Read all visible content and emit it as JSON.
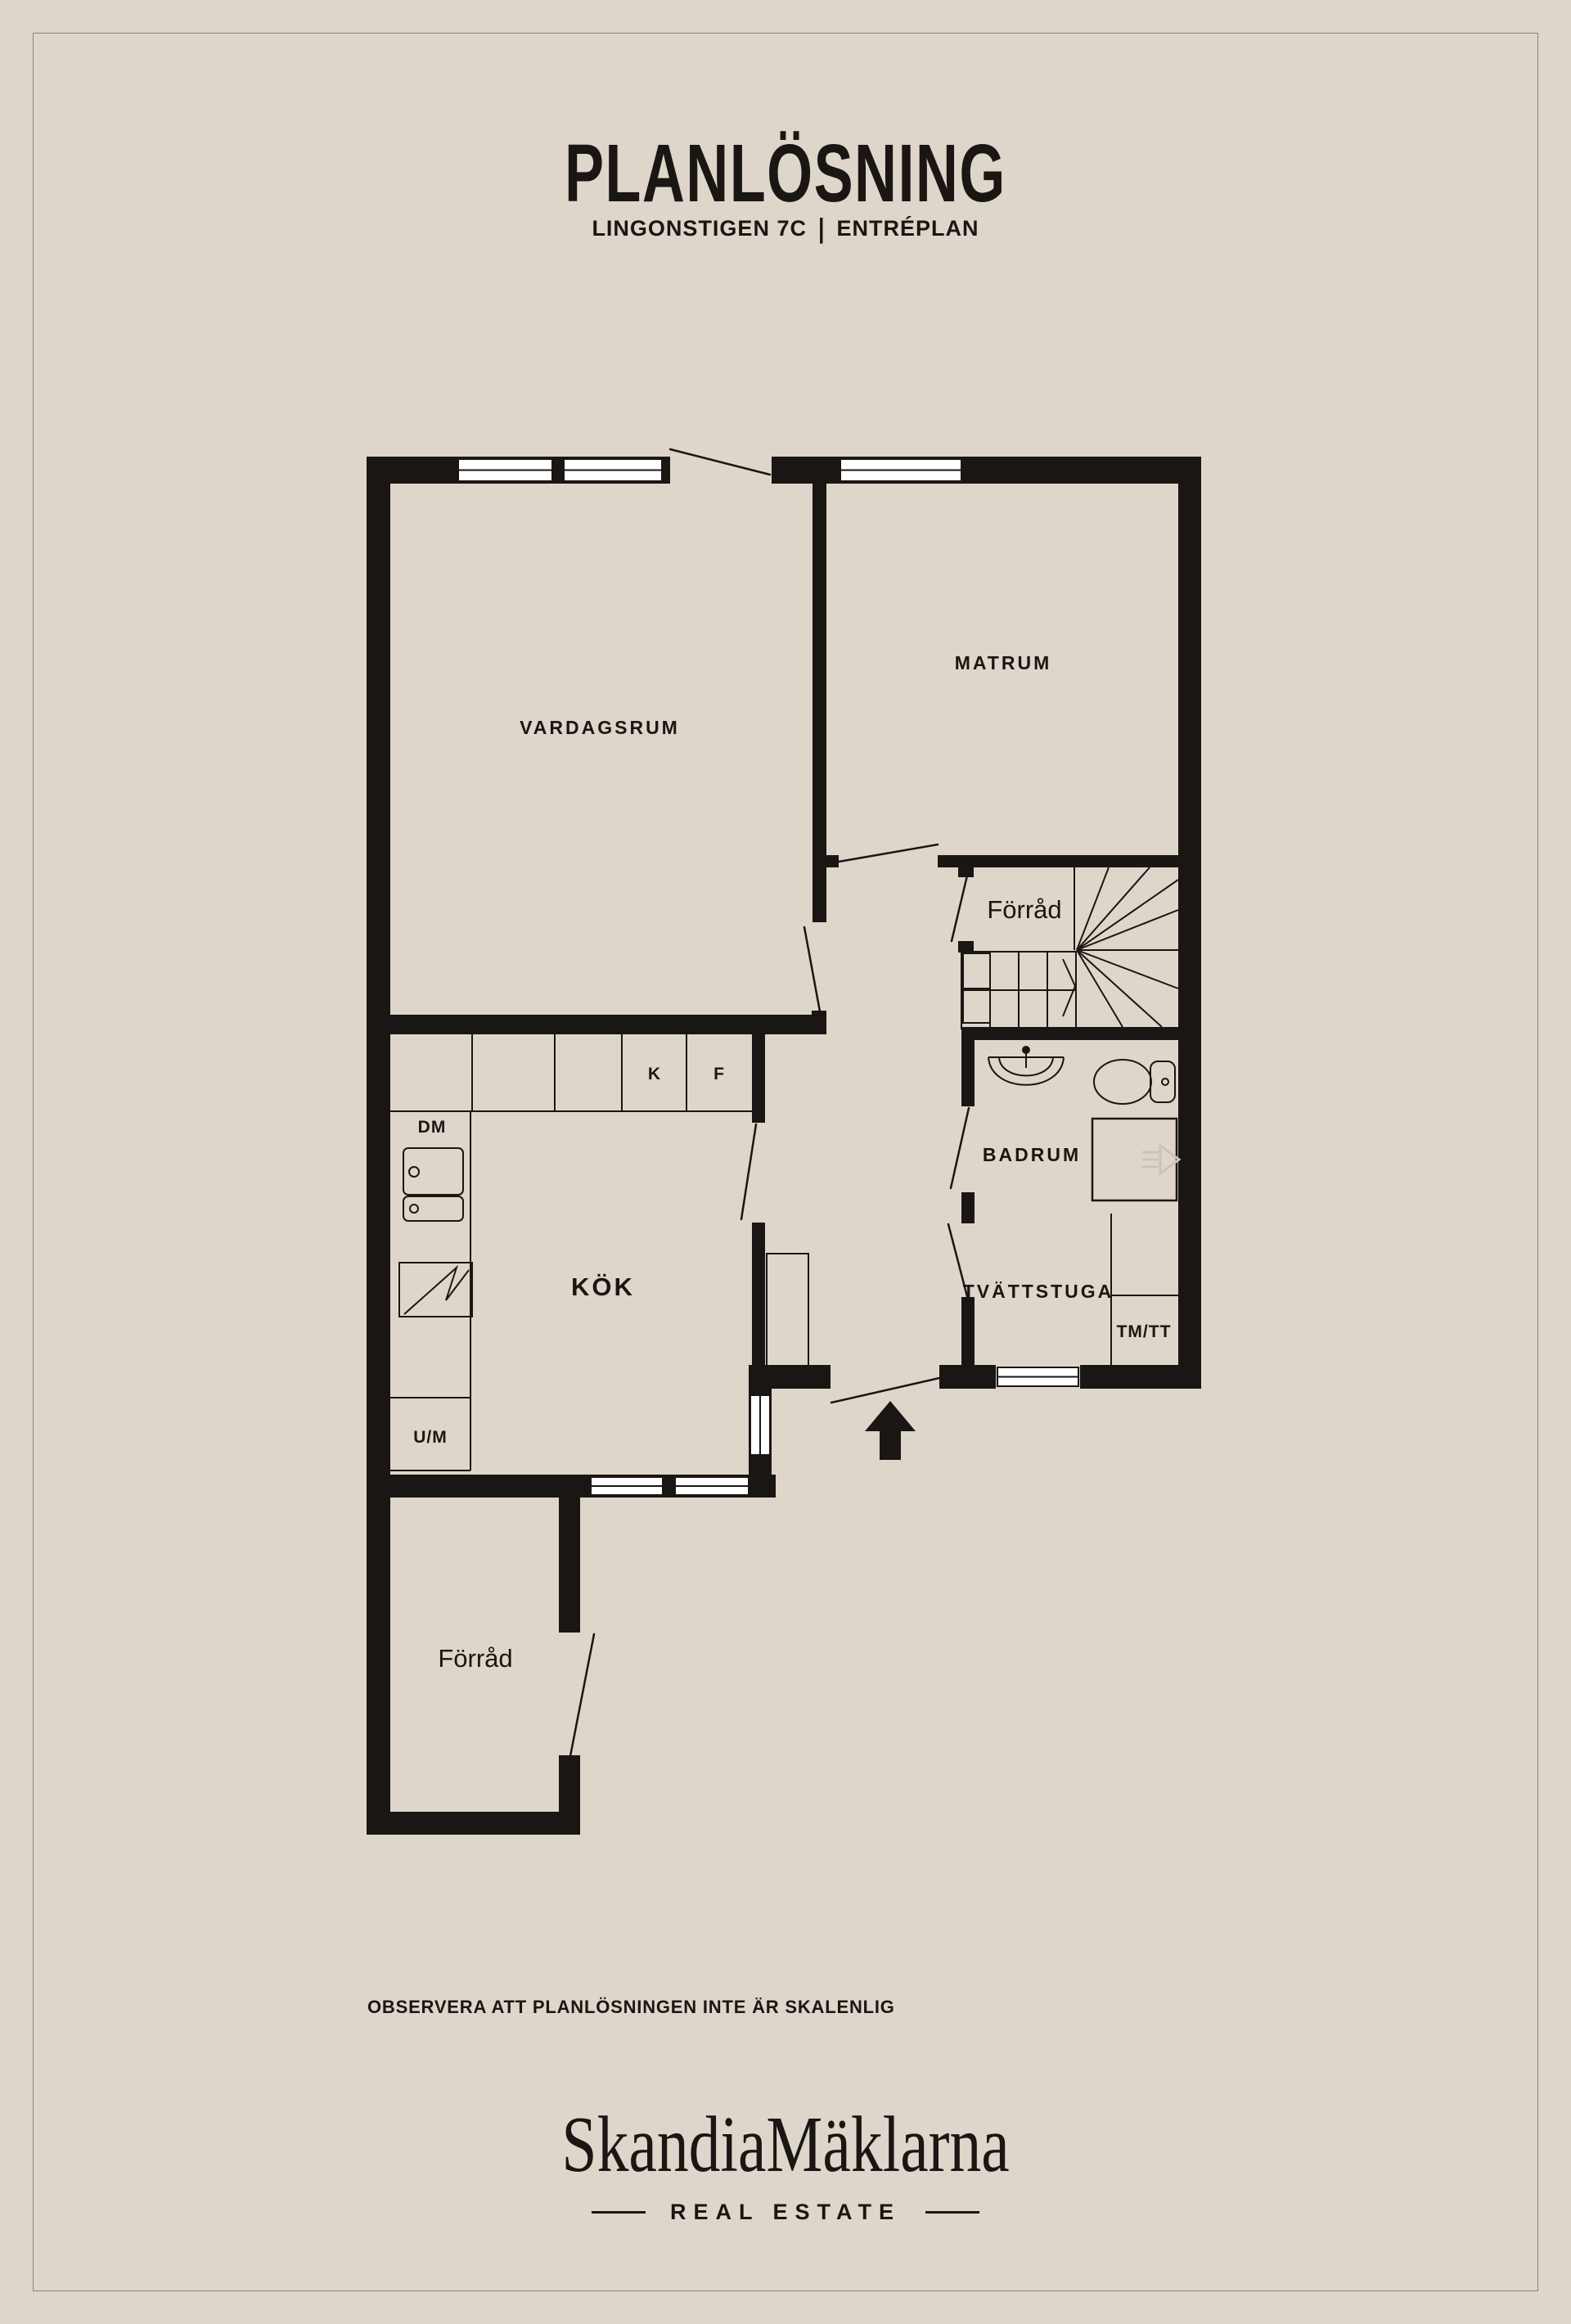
{
  "colors": {
    "background": "#ded6ca",
    "ink": "#1a1613",
    "frame_line": "#8a8376",
    "window_fill": "#ffffff",
    "ghost_icon": "#cdc3b5"
  },
  "header": {
    "title": "PLANLÖSNING",
    "address": "LINGONSTIGEN 7C",
    "separator": "|",
    "floor": "ENTRÉPLAN"
  },
  "floorplan": {
    "rooms": {
      "vardagsrum": {
        "label": "VARDAGSRUM"
      },
      "matrum": {
        "label": "MATRUM"
      },
      "forrad_upper": {
        "label": "Förråd"
      },
      "badrum": {
        "label": "BADRUM"
      },
      "tvattstuga": {
        "label": "TVÄTTSTUGA"
      },
      "kok": {
        "label": "KÖK"
      },
      "forrad_lower": {
        "label": "Förråd"
      }
    },
    "appliances": {
      "dm": {
        "label": "DM"
      },
      "k": {
        "label": "K"
      },
      "f": {
        "label": "F"
      },
      "um": {
        "label": "U/M"
      },
      "tmtt": {
        "label": "TM/TT"
      }
    }
  },
  "footer": {
    "disclaimer": "OBSERVERA ATT PLANLÖSNINGEN INTE ÄR SKALENLIG",
    "brand": "SkandiaMäklarna",
    "brand_sub": "REAL ESTATE"
  }
}
